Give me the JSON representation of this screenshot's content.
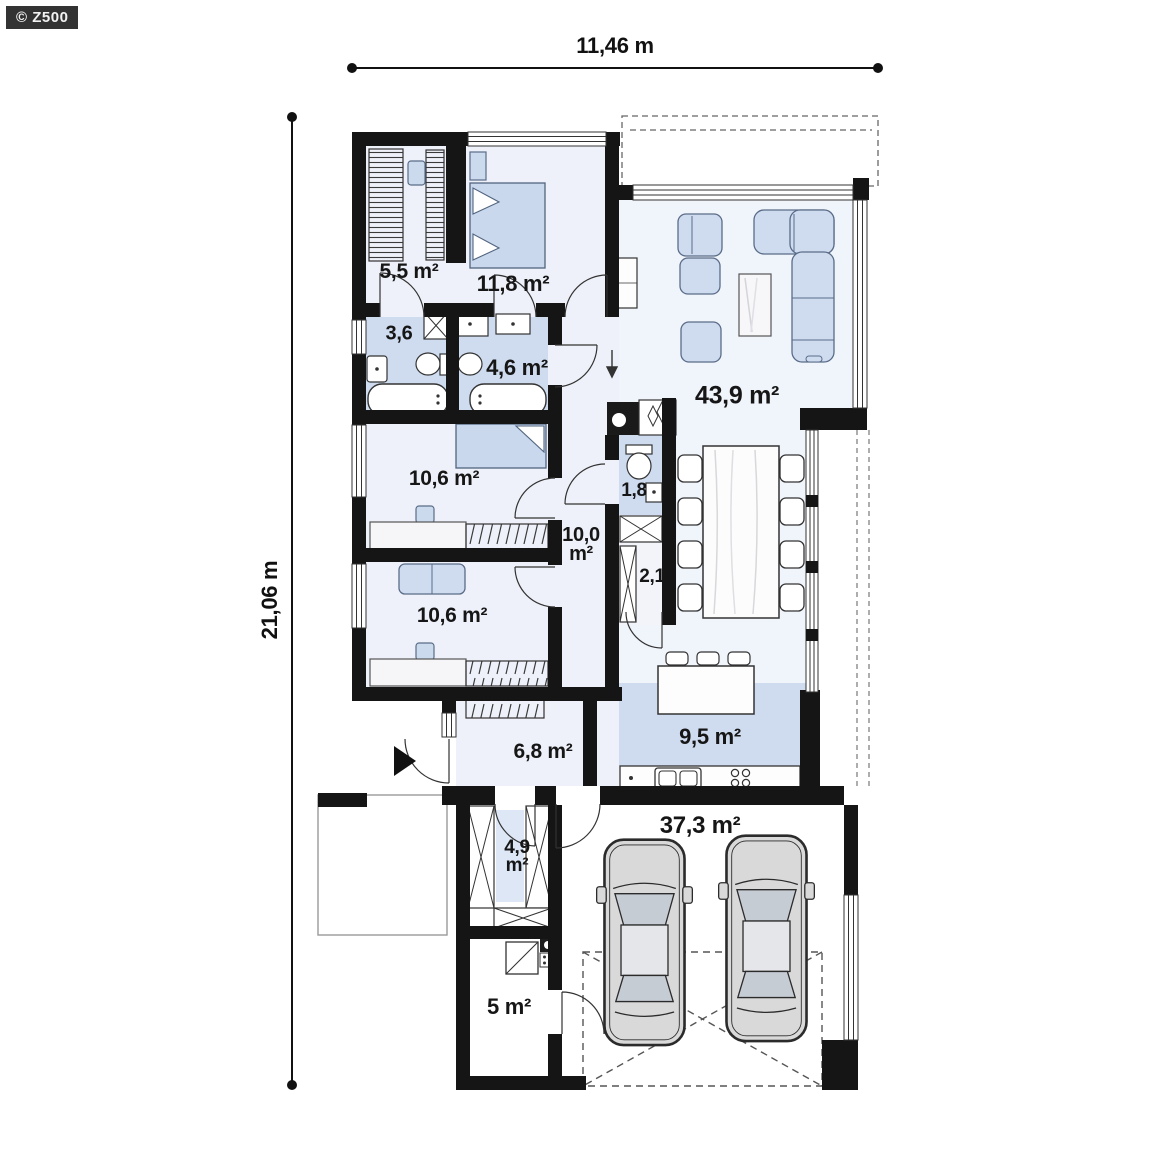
{
  "watermark": "© Z500",
  "dimensions": {
    "width": "11,46 m",
    "height": "21,06 m"
  },
  "rooms": [
    {
      "id": "wardrobe",
      "label": "5,5 m²"
    },
    {
      "id": "bedroom-1",
      "label": "11,8 m²"
    },
    {
      "id": "bathroom-small",
      "label": "3,6"
    },
    {
      "id": "bathroom",
      "label": "4,6 m²"
    },
    {
      "id": "living-room",
      "label": "43,9 m²"
    },
    {
      "id": "bedroom-2",
      "label": "10,6 m²"
    },
    {
      "id": "hallway",
      "line1": "10,0",
      "line2": "m²"
    },
    {
      "id": "wc",
      "label": "1,8"
    },
    {
      "id": "pantry",
      "label": "2,1"
    },
    {
      "id": "bedroom-3",
      "label": "10,6 m²"
    },
    {
      "id": "kitchen",
      "label": "9,5 m²"
    },
    {
      "id": "entry-hall",
      "label": "6,8 m²"
    },
    {
      "id": "utility",
      "line1": "4,9",
      "line2": "m²"
    },
    {
      "id": "garage",
      "label": "37,3 m²"
    },
    {
      "id": "boiler-room",
      "label": "5 m²"
    }
  ],
  "colors": {
    "wall": "#151515",
    "tiled_floor": "#cfdcef",
    "room_floor": "#eef1f9",
    "furniture_blue": "#ccdaee",
    "car_body": "#d9d9d9"
  }
}
